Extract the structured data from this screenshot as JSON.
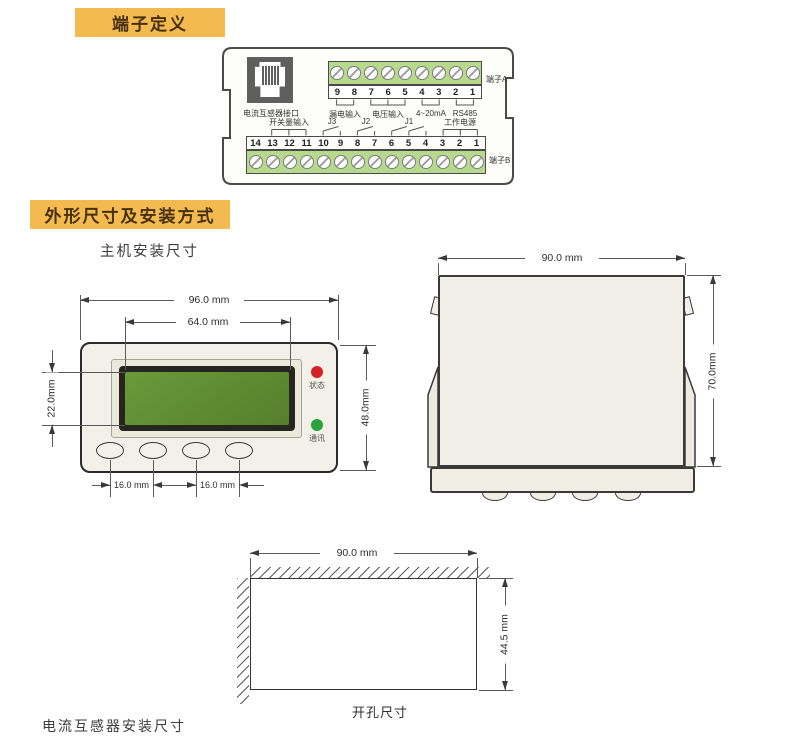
{
  "section_terminal": {
    "title": "端子定义"
  },
  "section_dims": {
    "title": "外形尺寸及安装方式",
    "subtitle": "主机安装尺寸",
    "clipped_bottom_text": "电流互感器安装尺寸"
  },
  "terminal_diagram": {
    "rj45_label": "电流互感器接口",
    "rowA": {
      "side_label": "端子A",
      "numbers": [
        "9",
        "8",
        "7",
        "6",
        "5",
        "4",
        "3",
        "2",
        "1"
      ],
      "groups": [
        {
          "label": "漏电输入"
        },
        {
          "label": "电压输入"
        },
        {
          "label": "4~20mA"
        },
        {
          "label": "RS485"
        }
      ]
    },
    "rowB": {
      "side_label": "端子B",
      "numbers": [
        "14",
        "13",
        "12",
        "11",
        "10",
        "9",
        "8",
        "7",
        "6",
        "5",
        "4",
        "3",
        "2",
        "1"
      ],
      "groups": [
        {
          "label": "开关量输入"
        },
        {
          "label": "J3"
        },
        {
          "label": "J2"
        },
        {
          "label": "J1"
        },
        {
          "label": "工作电源"
        }
      ]
    }
  },
  "front_view": {
    "dim_width": "96.0 mm",
    "dim_lcd_width": "64.0 mm",
    "dim_lcd_height": "22.0mm",
    "dim_height": "48.0mm",
    "dim_btn_pitch_left": "16.0 mm",
    "dim_btn_pitch_right": "16.0 mm",
    "led_status_label": "状态",
    "led_comm_label": "通讯"
  },
  "side_view": {
    "dim_width": "90.0 mm",
    "dim_height": "70.0mm"
  },
  "cutout_view": {
    "dim_width": "90.0 mm",
    "dim_height": "44.5 mm",
    "caption": "开孔尺寸"
  },
  "colors": {
    "banner_bg": "#f5ba4f",
    "banner_text": "#46300c",
    "terminal_green": "#b6d98b",
    "lcd_green": "#5e8c33",
    "led_red": "#d42127",
    "led_green": "#2ba33c"
  }
}
